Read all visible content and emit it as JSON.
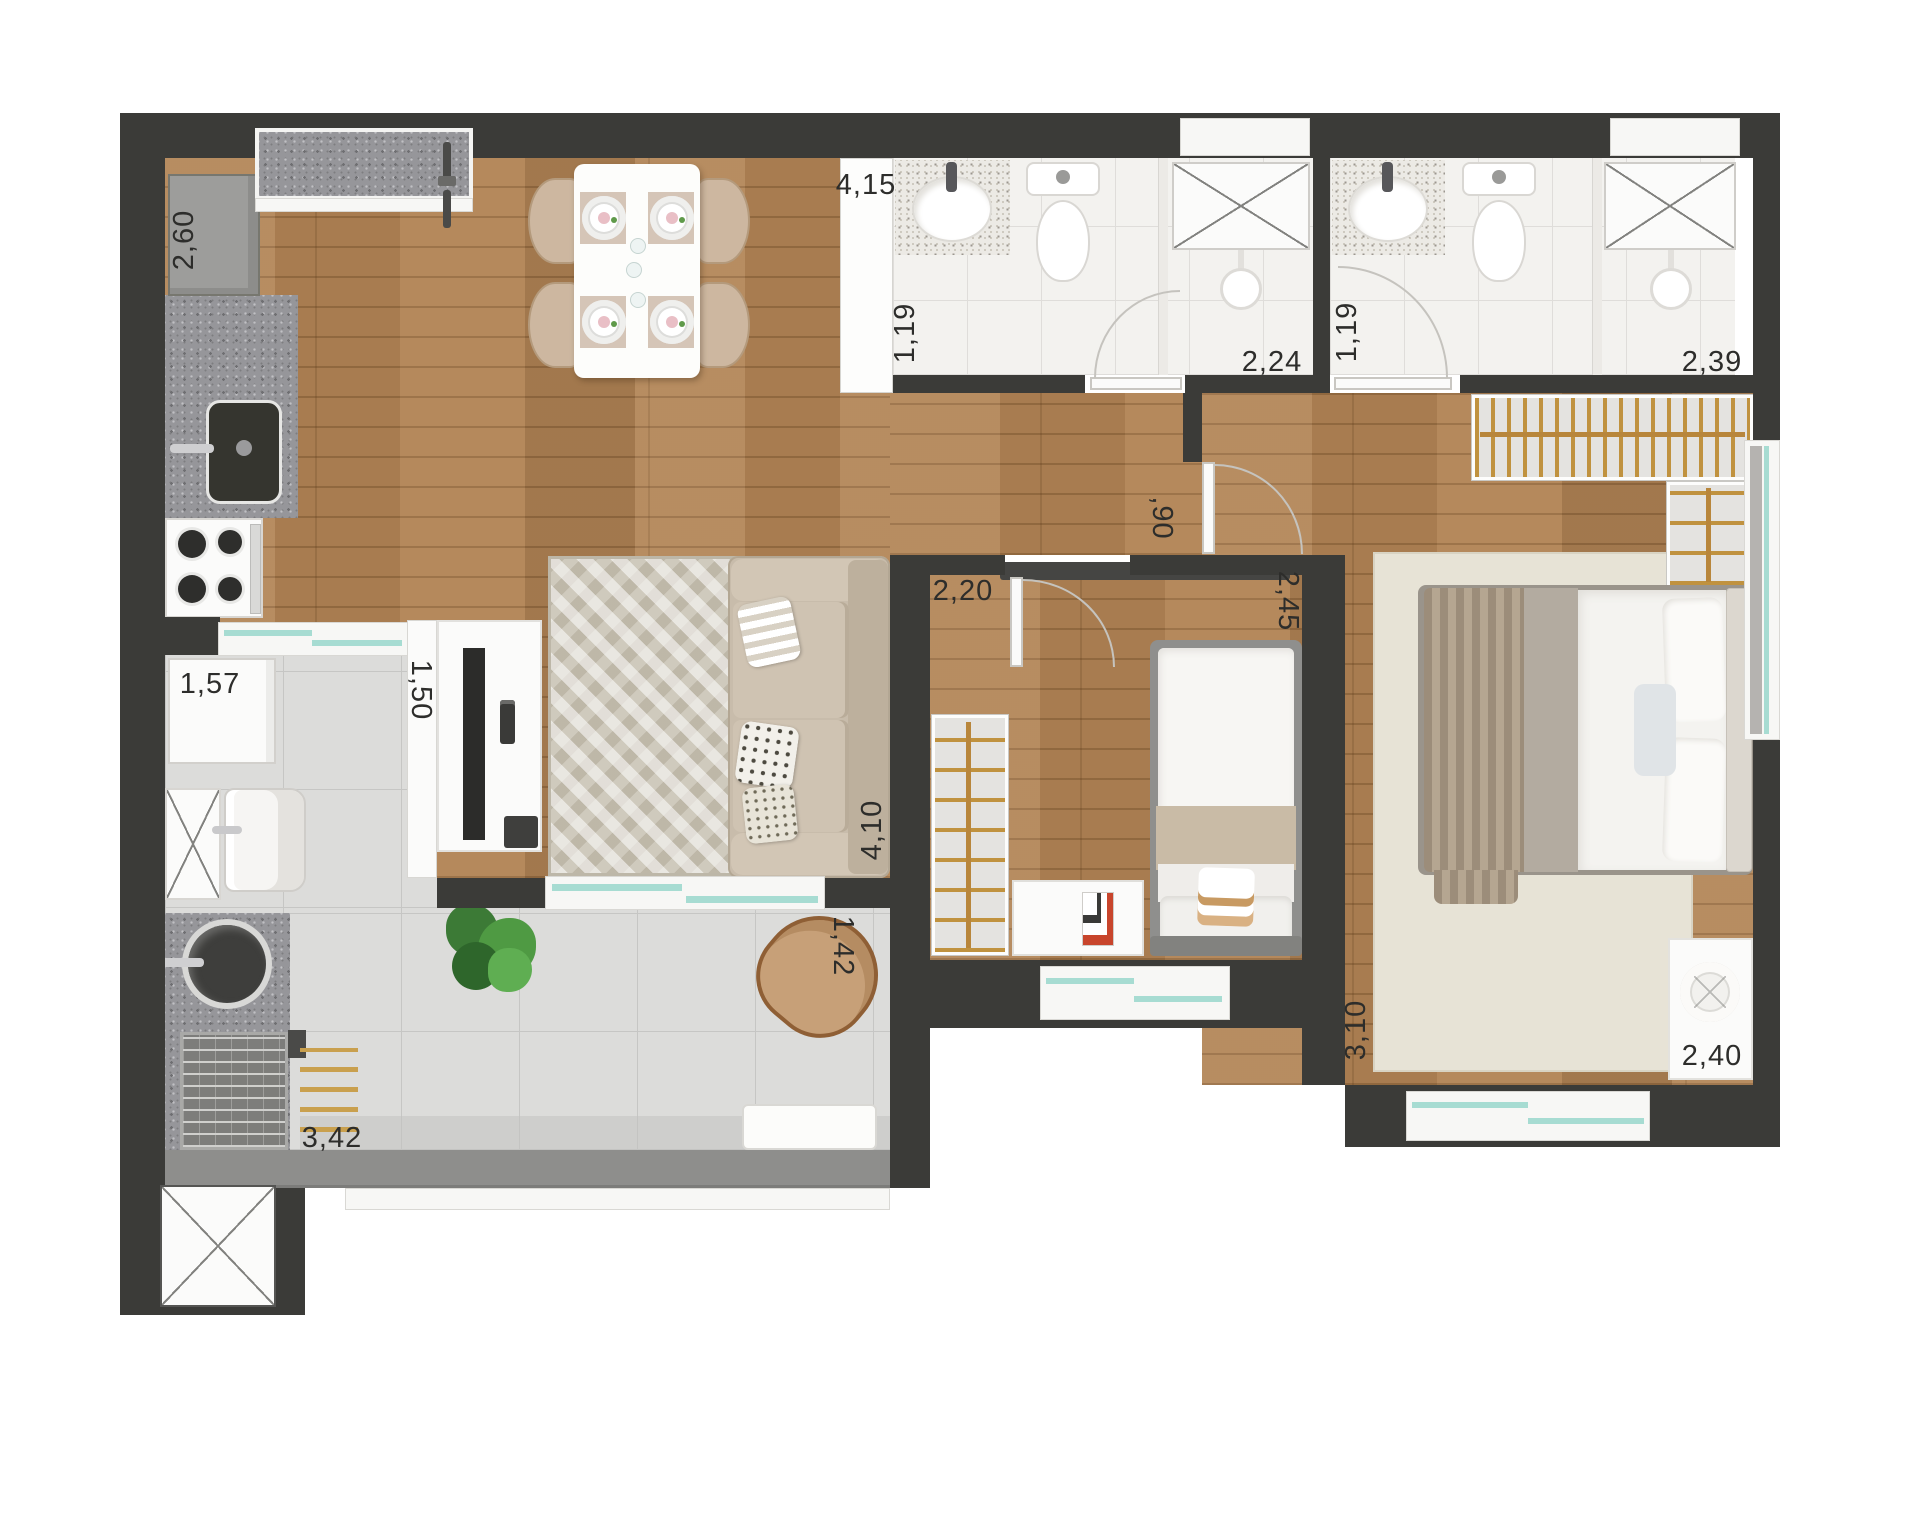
{
  "plan": {
    "kind": "apartment floor plan (top-down rendered)",
    "rooms": [
      "kitchen",
      "dining",
      "living",
      "bathroom-1",
      "bathroom-2",
      "hallway",
      "bedroom-2",
      "master-bedroom",
      "service-area",
      "gourmet-terrace"
    ]
  },
  "dimension_labels": {
    "refrigerator": {
      "value": "2,60",
      "orientation": "vertical"
    },
    "entry_span": {
      "value": "4,15",
      "orientation": "horizontal"
    },
    "bath1_width": {
      "value": "1,19",
      "orientation": "vertical"
    },
    "bath1_length": {
      "value": "2,24",
      "orientation": "horizontal"
    },
    "bath2_width": {
      "value": "1,19",
      "orientation": "vertical"
    },
    "bath2_length": {
      "value": "2,39",
      "orientation": "horizontal"
    },
    "hall_width": {
      "value": ",90",
      "orientation": "vertical"
    },
    "bedroom2_entry": {
      "value": "2,20",
      "orientation": "horizontal"
    },
    "bedroom2_width": {
      "value": "2,45",
      "orientation": "vertical"
    },
    "washer": {
      "value": "1,57",
      "orientation": "horizontal"
    },
    "service_door": {
      "value": "1,50",
      "orientation": "vertical"
    },
    "living_length": {
      "value": "4,10",
      "orientation": "vertical"
    },
    "terrace_depth": {
      "value": "1,42",
      "orientation": "vertical"
    },
    "master_length": {
      "value": "3,10",
      "orientation": "vertical"
    },
    "master_width": {
      "value": "2,40",
      "orientation": "horizontal"
    },
    "terrace_length": {
      "value": "3,42",
      "orientation": "horizontal"
    }
  },
  "colors": {
    "wall": "#3b3b38",
    "wood_floor": "#b28455",
    "tile_gray": "#dcdcda",
    "tile_bath": "#f3f2ef",
    "granite": "#96969a",
    "glass_teal": "#a7dcd2",
    "hanger_gold": "#b8863b",
    "label_text": "#2d2d2b"
  },
  "fixtures": [
    "refrigerator-icon",
    "kitchen-sink-icon",
    "stove-icon",
    "dining-table-icon",
    "dining-chair-icon",
    "plate-setting-icon",
    "entry-door-handle-icon",
    "tv-panel-icon",
    "sofa-icon",
    "area-rug-icon",
    "washing-machine-icon",
    "laundry-tub-icon",
    "utility-cabinet-icon",
    "sliding-door-icon",
    "plant-icon",
    "armchair-icon",
    "bench-icon",
    "grill-icon",
    "bowl-sink-icon",
    "skewers-icon",
    "toilet-icon",
    "washbasin-icon",
    "shower-tray-icon",
    "shower-head-icon",
    "swing-door-icon",
    "wardrobe-hangers-icon",
    "single-bed-icon",
    "double-bed-icon",
    "nightstand-icon",
    "lamp-icon",
    "window-icon",
    "duct-shaft-icon"
  ]
}
